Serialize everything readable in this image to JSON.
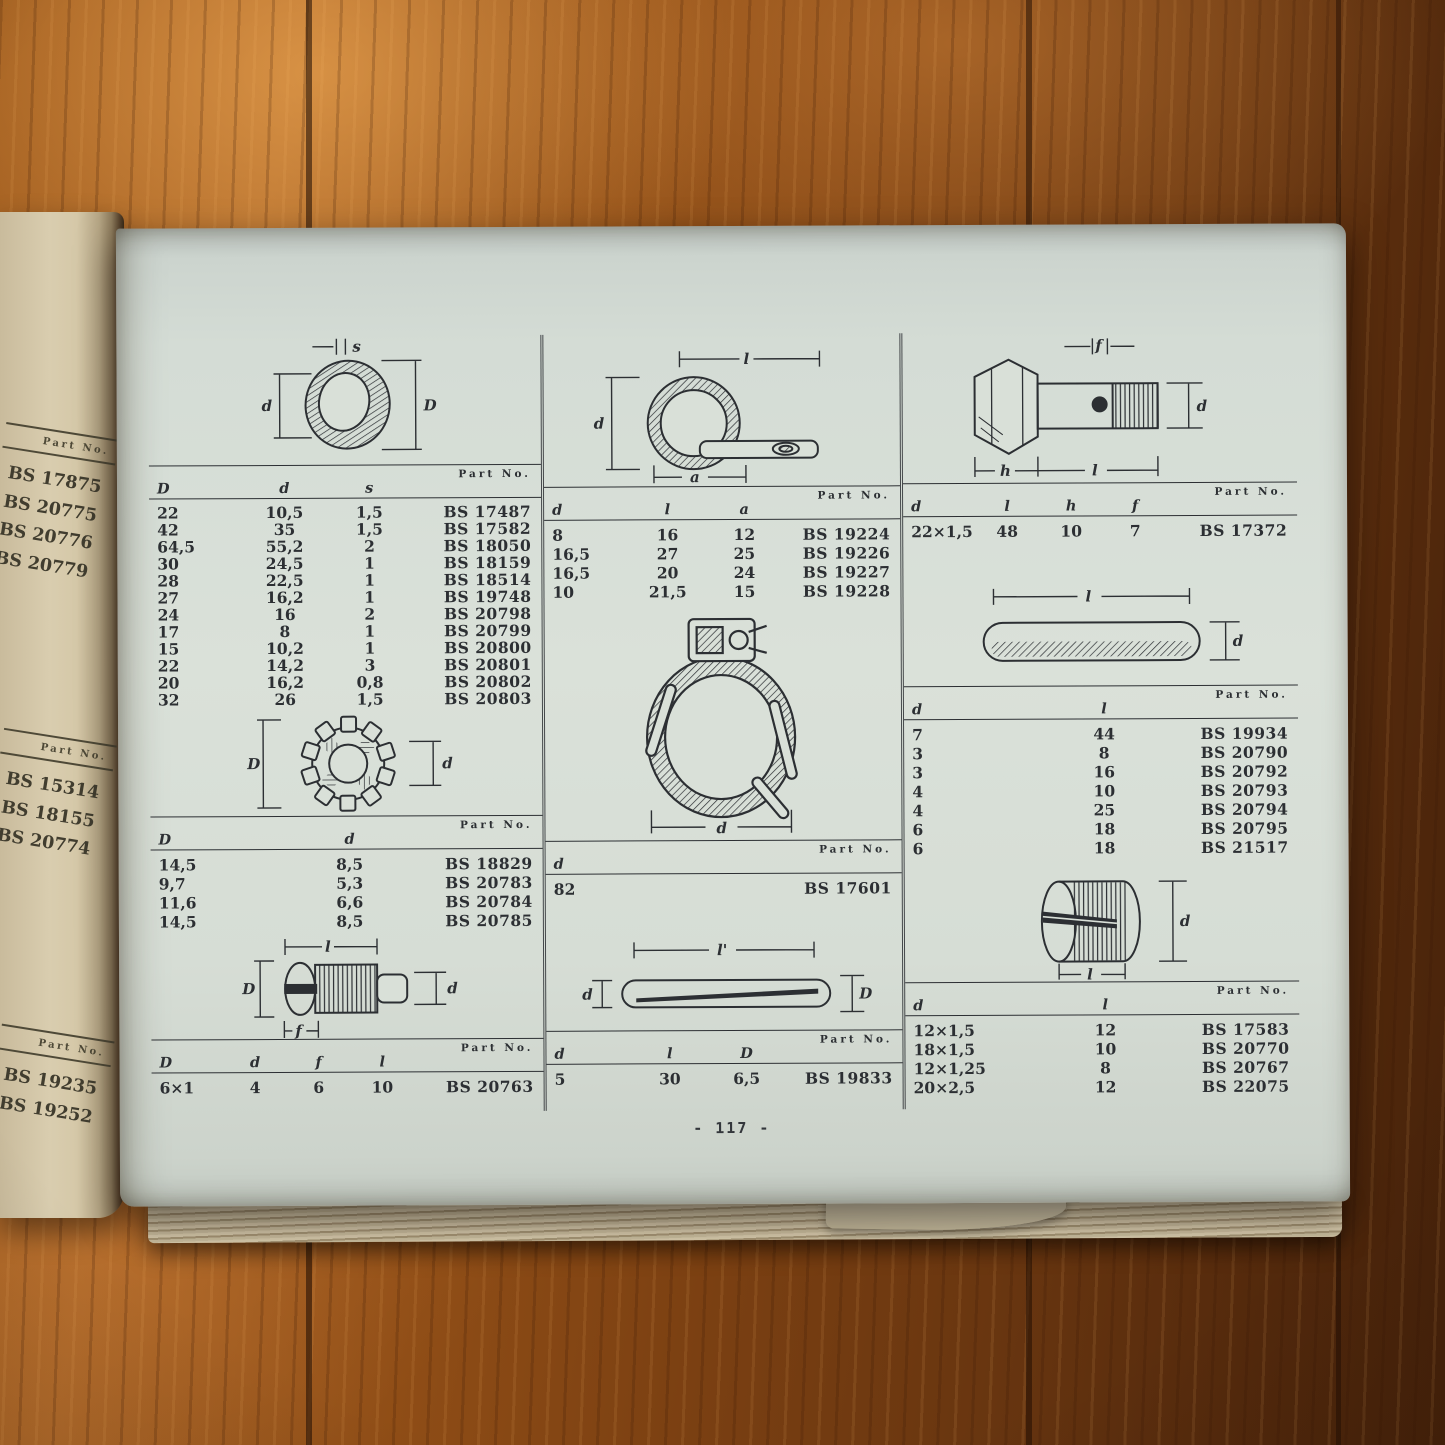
{
  "colors": {
    "paper": "#d9e0d8",
    "ink": "#2c2f33",
    "left_page_paper": "#d9cdaf",
    "wood_light": "#b06a2a",
    "wood_dark": "#4f2a0c"
  },
  "page": {
    "number": "- 117 -"
  },
  "left_page_strip": {
    "sections": [
      {
        "part_header": "Part No.",
        "parts": [
          "BS 17875",
          "BS 20775",
          "BS 20776",
          "BS 20779"
        ]
      },
      {
        "part_header": "Part No.",
        "parts": [
          "BS 15314",
          "BS 18155",
          "BS 20774"
        ]
      },
      {
        "part_header": "Part No.",
        "parts": [
          "BS 19235",
          "BS 19252"
        ]
      }
    ]
  },
  "figures": {
    "washer": {
      "labels": {
        "top": "s",
        "left": "d",
        "right": "D"
      }
    },
    "lock_washer": {
      "labels": {
        "left": "D",
        "right": "d"
      }
    },
    "slotted_screw": {
      "labels": {
        "top": "l",
        "left": "D",
        "right": "d",
        "bottom": "f"
      }
    },
    "p_clip": {
      "labels": {
        "top": "l",
        "left": "d",
        "bottom": "a"
      }
    },
    "hose_clamp": {
      "labels": {
        "bottom": "d"
      }
    },
    "flat_pin": {
      "labels": {
        "top": "l'",
        "left": "d",
        "right": "D"
      }
    },
    "banjo_bolt": {
      "labels": {
        "top": "f",
        "right": "d",
        "bottom_left": "h",
        "bottom": "l"
      }
    },
    "round_pin": {
      "labels": {
        "top": "l",
        "right": "d"
      }
    },
    "slotted_plug": {
      "labels": {
        "right": "d",
        "bottom": "l"
      }
    }
  },
  "tables": {
    "washers": {
      "part_header": "Part No.",
      "columns": [
        "D",
        "d",
        "s"
      ],
      "rows": [
        [
          "22",
          "10,5",
          "1,5",
          "BS 17487"
        ],
        [
          "42",
          "35",
          "1,5",
          "BS 17582"
        ],
        [
          "64,5",
          "55,2",
          "2",
          "BS 18050"
        ],
        [
          "30",
          "24,5",
          "1",
          "BS 18159"
        ],
        [
          "28",
          "22,5",
          "1",
          "BS 18514"
        ],
        [
          "27",
          "16,2",
          "1",
          "BS 19748"
        ],
        [
          "24",
          "16",
          "2",
          "BS 20798"
        ],
        [
          "17",
          "8",
          "1",
          "BS 20799"
        ],
        [
          "15",
          "10,2",
          "1",
          "BS 20800"
        ],
        [
          "22",
          "14,2",
          "3",
          "BS 20801"
        ],
        [
          "20",
          "16,2",
          "0,8",
          "BS 20802"
        ],
        [
          "32",
          "26",
          "1,5",
          "BS 20803"
        ]
      ]
    },
    "lock_washers": {
      "part_header": "Part No.",
      "columns": [
        "D",
        "d"
      ],
      "rows": [
        [
          "14,5",
          "8,5",
          "BS 18829"
        ],
        [
          "9,7",
          "5,3",
          "BS 20783"
        ],
        [
          "11,6",
          "6,6",
          "BS 20784"
        ],
        [
          "14,5",
          "8,5",
          "BS 20785"
        ]
      ]
    },
    "screws": {
      "part_header": "Part No.",
      "columns": [
        "D",
        "d",
        "f",
        "l"
      ],
      "rows": [
        [
          "6×1",
          "4",
          "6",
          "10",
          "BS 20763"
        ]
      ]
    },
    "clips": {
      "part_header": "Part No.",
      "columns": [
        "d",
        "l",
        "a"
      ],
      "rows": [
        [
          "8",
          "16",
          "12",
          "BS 19224"
        ],
        [
          "16,5",
          "27",
          "25",
          "BS 19226"
        ],
        [
          "16,5",
          "20",
          "24",
          "BS 19227"
        ],
        [
          "10",
          "21,5",
          "15",
          "BS 19228"
        ]
      ]
    },
    "clamps": {
      "part_header": "Part No.",
      "columns": [
        "d"
      ],
      "rows": [
        [
          "82",
          "BS 17601"
        ]
      ]
    },
    "pins_mid": {
      "part_header": "Part No.",
      "columns": [
        "d",
        "l",
        "D"
      ],
      "rows": [
        [
          "5",
          "30",
          "6,5",
          "BS 19833"
        ]
      ]
    },
    "bolts": {
      "part_header": "Part No.",
      "columns": [
        "d",
        "l",
        "h",
        "f"
      ],
      "rows": [
        [
          "22×1,5",
          "48",
          "10",
          "7",
          "BS 17372"
        ]
      ]
    },
    "pins_right": {
      "part_header": "Part No.",
      "columns": [
        "d",
        "l"
      ],
      "rows": [
        [
          "7",
          "44",
          "BS 19934"
        ],
        [
          "3",
          "8",
          "BS 20790"
        ],
        [
          "3",
          "16",
          "BS 20792"
        ],
        [
          "4",
          "10",
          "BS 20793"
        ],
        [
          "4",
          "25",
          "BS 20794"
        ],
        [
          "6",
          "18",
          "BS 20795"
        ],
        [
          "6",
          "18",
          "BS 21517"
        ]
      ]
    },
    "plugs": {
      "part_header": "Part No.",
      "columns": [
        "d",
        "l"
      ],
      "rows": [
        [
          "12×1,5",
          "12",
          "BS 17583"
        ],
        [
          "18×1,5",
          "10",
          "BS 20770"
        ],
        [
          "12×1,25",
          "8",
          "BS 20767"
        ],
        [
          "20×2,5",
          "12",
          "BS 22075"
        ]
      ]
    }
  }
}
